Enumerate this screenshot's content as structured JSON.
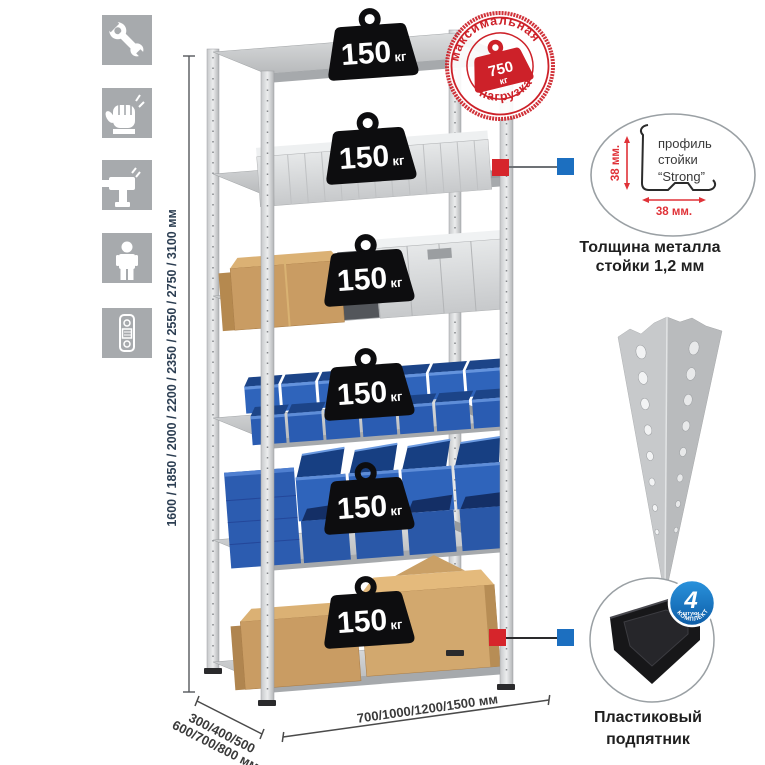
{
  "title": "shelving-rack-infographic",
  "colors": {
    "accent_red": "#cd2129",
    "accent_blue": "#1c6fc0",
    "icon_tile_gray": "#a7aaad",
    "bin_blue": "#2e63ba",
    "dimension_text": "#2c3e52"
  },
  "sidebar": {
    "icons": [
      {
        "name": "wrench"
      },
      {
        "name": "gloves"
      },
      {
        "name": "drill"
      },
      {
        "name": "person"
      },
      {
        "name": "spirit-level"
      }
    ]
  },
  "dimensions": {
    "height_label": "1600 / 1850 / 2000 / 2200 / 2350 / 2550 / 2750 / 3100 мм",
    "depth_label_line1": "300/400/500",
    "depth_label_line2": "600/700/800 мм",
    "width_label": "700/1000/1200/1500 мм"
  },
  "max_load_stamp": {
    "arc_top": "максимальная",
    "arc_bottom": "нагрузка",
    "value": "750",
    "unit": "кг"
  },
  "shelf_load": {
    "value": "150",
    "unit": "кг"
  },
  "profile_detail": {
    "dim_vertical": "38 мм.",
    "dim_horizontal": "38 мм.",
    "label_line1": "профиль",
    "label_line2": "стойки",
    "label_line3": "“Strong”",
    "caption_line1": "Толщина металла",
    "caption_line2": "стойки 1,2 мм"
  },
  "foot_detail": {
    "badge_value": "4",
    "badge_sub": "штуки",
    "badge_arc": "В КОМПЛЕКТЕ",
    "caption_line1": "Пластиковый",
    "caption_line2": "подпятник"
  }
}
